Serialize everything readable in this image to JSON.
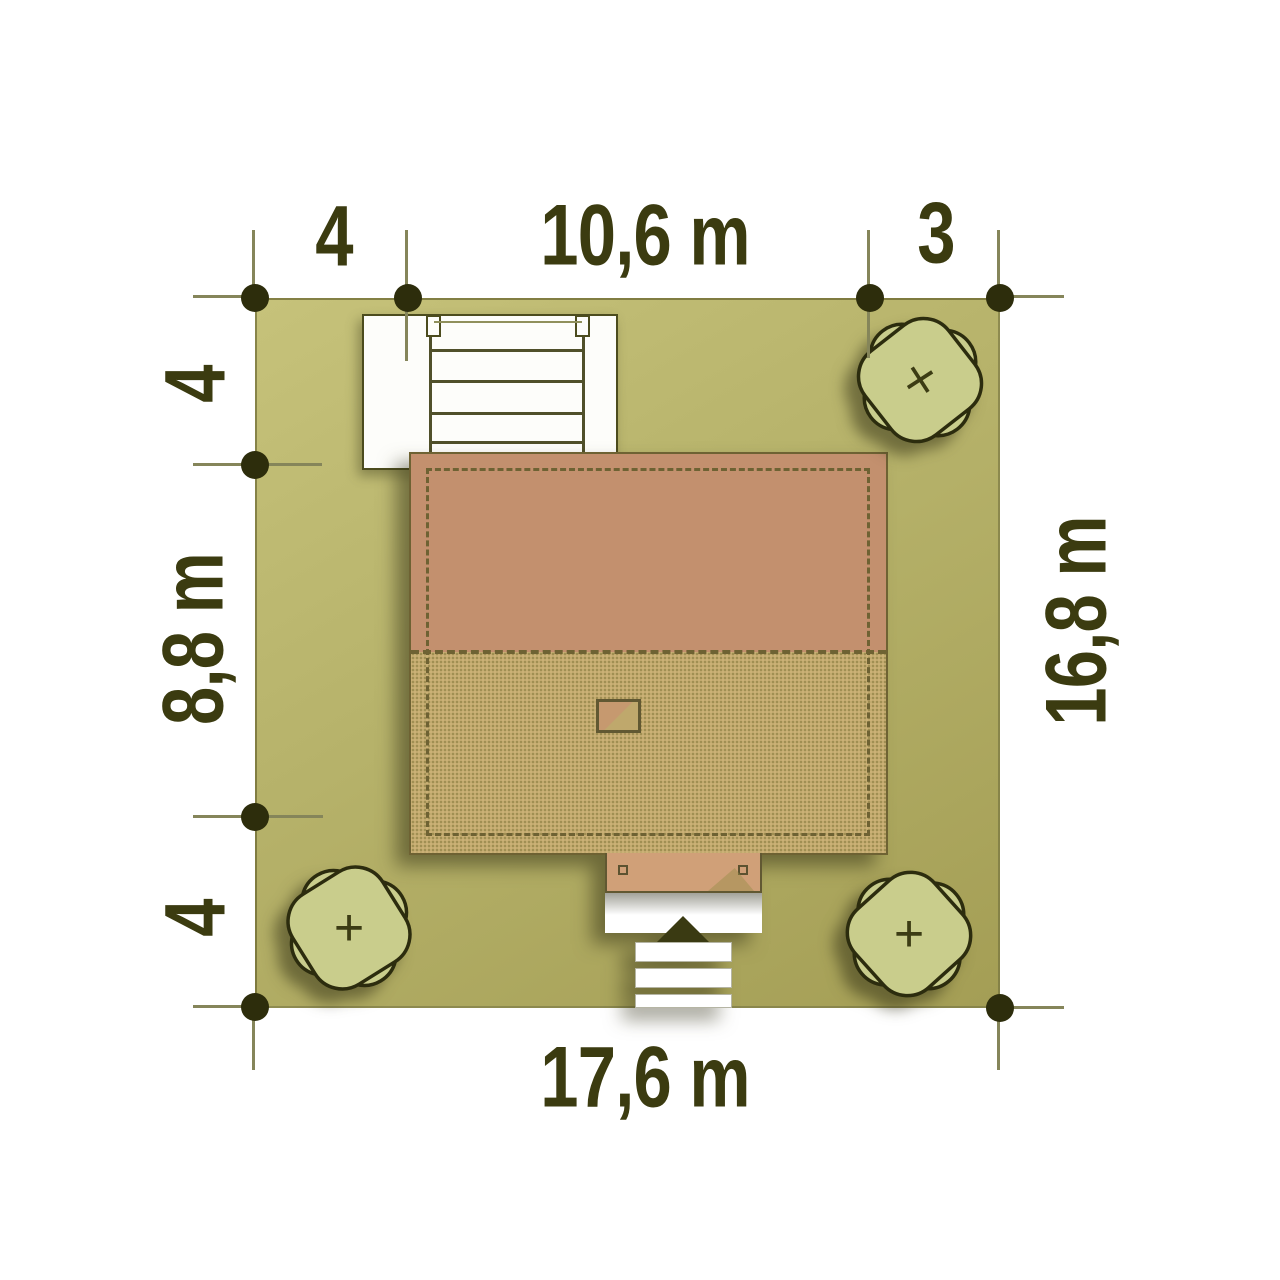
{
  "diagram": {
    "type": "house-site-plan"
  },
  "dimensions": {
    "top": [
      {
        "label": "4"
      },
      {
        "label": "10,6 m"
      },
      {
        "label": "3"
      }
    ],
    "left": [
      {
        "label": "4"
      },
      {
        "label": "8,8 m"
      },
      {
        "label": "4"
      }
    ],
    "right": [
      {
        "label": "16,8 m"
      }
    ],
    "bottom": [
      {
        "label": "17,6 m"
      }
    ]
  },
  "trees": [
    {
      "position": "top-right",
      "symbol": "×"
    },
    {
      "position": "bottom-left",
      "symbol": "+"
    },
    {
      "position": "bottom-right",
      "symbol": "+"
    }
  ],
  "colors": {
    "plot_green": "#b5b26a",
    "roof_upper": "#c3906e",
    "roof_lower": "#c2b074",
    "porch_tan": "#d0a078",
    "tree_green": "#c9cd8c",
    "label_text": "#3b3b10",
    "marker_dot": "#2d2d0c",
    "dimension_line": "#85855a",
    "paving_white": "#ffffff",
    "entrance_arrow": "#3a3a12"
  }
}
